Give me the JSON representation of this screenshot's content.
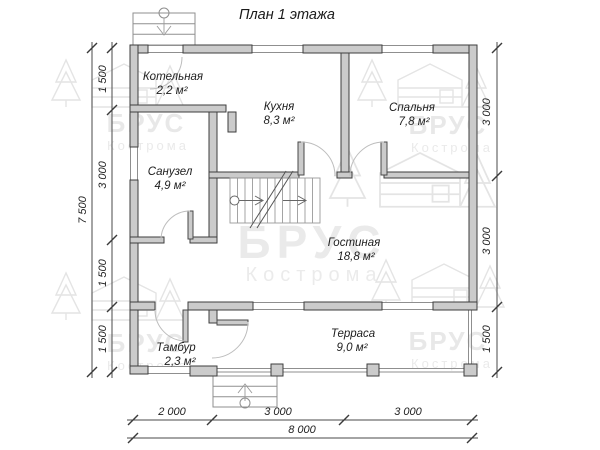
{
  "title": "План 1 этажа",
  "rooms": [
    {
      "name": "Котельная",
      "area": "2,2 м²"
    },
    {
      "name": "Кухня",
      "area": "8,3 м²"
    },
    {
      "name": "Спальня",
      "area": "7,8 м²"
    },
    {
      "name": "Санузел",
      "area": "4,9 м²"
    },
    {
      "name": "Гостиная",
      "area": "18,8 м²"
    },
    {
      "name": "Тамбур",
      "area": "2,3 м²"
    },
    {
      "name": "Терраса",
      "area": "9,0 м²"
    }
  ],
  "dimensions": {
    "left_total": "7 500",
    "left": [
      "1 500",
      "3 000",
      "1 500",
      "1 500"
    ],
    "right": [
      "3 000",
      "3 000",
      "1 500"
    ],
    "bottom": [
      "2 000",
      "3 000",
      "3 000"
    ],
    "bottom_total": "8 000"
  },
  "watermark": {
    "brand": "БРУС",
    "city": "Кострома"
  }
}
